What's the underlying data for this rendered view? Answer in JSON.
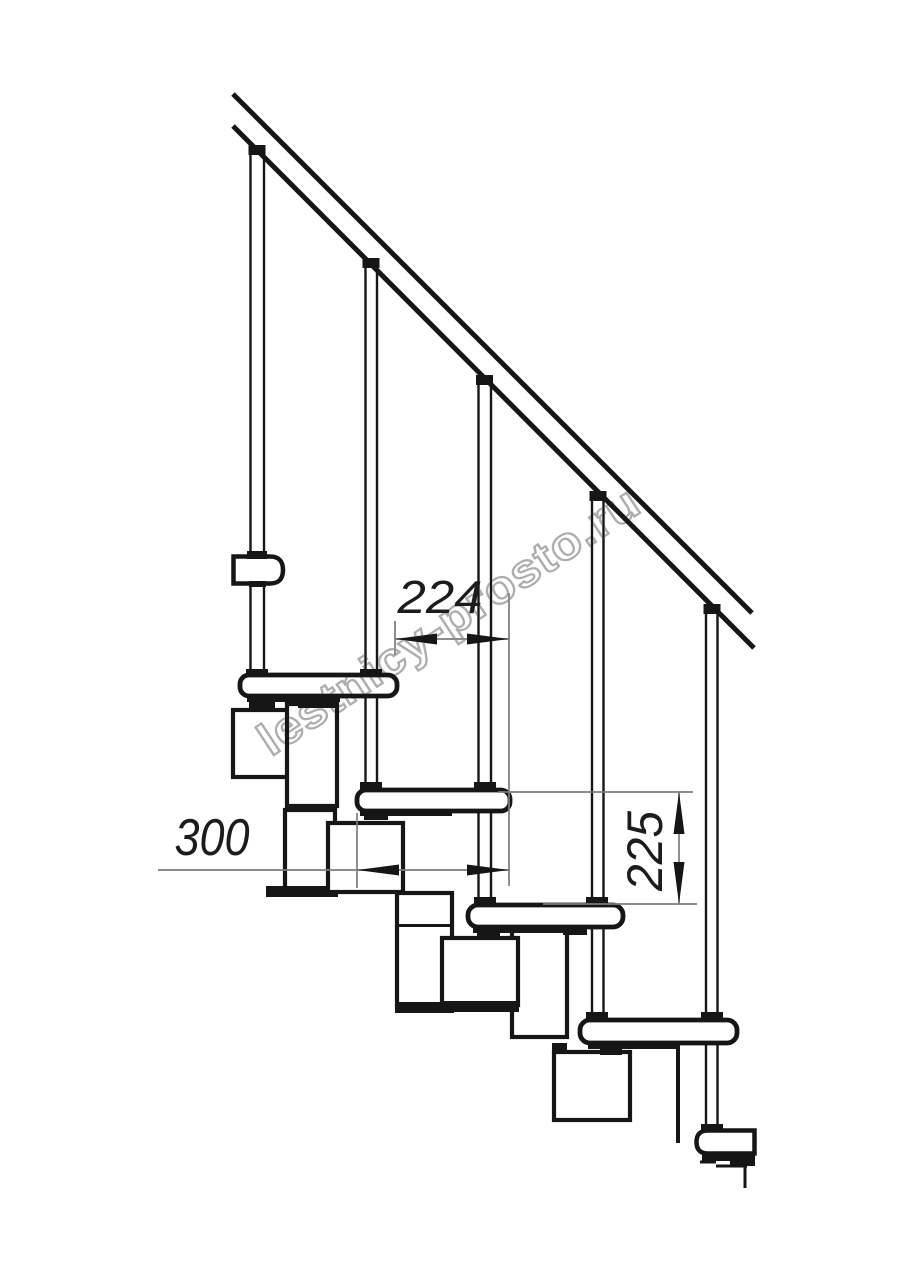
{
  "drawing": {
    "description": "Modular staircase side-view technical drawing",
    "watermark": "lestnicy-prosto.ru",
    "dimensions": {
      "step_run_mm": "224",
      "tread_length_mm": "300",
      "step_rise_mm": "225"
    },
    "colors": {
      "line": "#161616",
      "dimension_line": "#7b7b7b",
      "watermark_stroke": "#a9a9a9",
      "background": "#ffffff"
    }
  }
}
